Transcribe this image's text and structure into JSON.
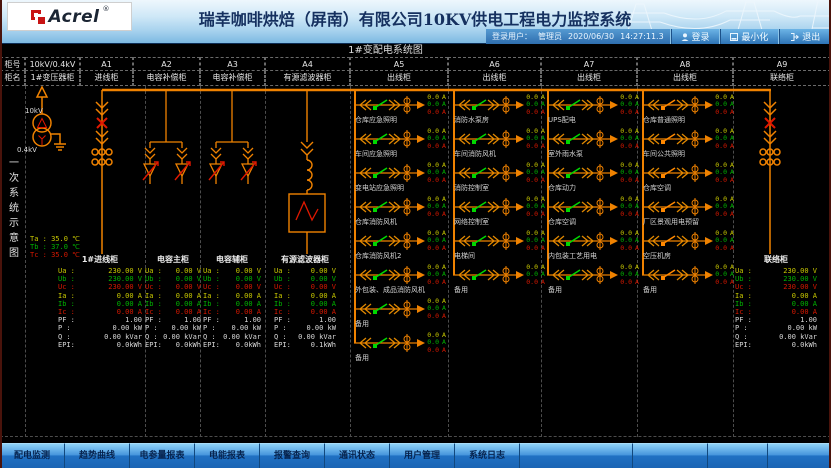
{
  "header": {
    "brand": "Acrel",
    "brand_reg": "®",
    "title": "瑞幸咖啡烘焙（屏南）有限公司10KV供电工程电力监控系统",
    "user_label": "登录用户：",
    "user_name": "管理员",
    "date": "2020/06/30",
    "time": "14:27:11.3",
    "login_label": "登录",
    "minimize_label": "最小化",
    "exit_label": "退出"
  },
  "diagram": {
    "title": "1#变配电系统图",
    "side_label": "一次系统示意图",
    "row_header_no": "柜号",
    "row_header_name": "柜名",
    "cabinets": [
      {
        "id": "T",
        "no": "10kV/0.4kV",
        "name": "1#变压器柜"
      },
      {
        "id": "A1",
        "no": "A1",
        "name": "进线柜"
      },
      {
        "id": "A2",
        "no": "A2",
        "name": "电容补偿柜"
      },
      {
        "id": "A3",
        "no": "A3",
        "name": "电容补偿柜"
      },
      {
        "id": "A4",
        "no": "A4",
        "name": "有源滤波器柜"
      },
      {
        "id": "A5",
        "no": "A5",
        "name": "出线柜"
      },
      {
        "id": "A6",
        "no": "A6",
        "name": "出线柜"
      },
      {
        "id": "A7",
        "no": "A7",
        "name": "出线柜"
      },
      {
        "id": "A8",
        "no": "A8",
        "name": "出线柜"
      },
      {
        "id": "A9",
        "no": "A9",
        "name": "联络柜"
      }
    ],
    "transformer": {
      "hv_label": "10kV",
      "lv_label": "0.4kV",
      "temperatures": [
        {
          "label": "Ta :",
          "value": "35.0 ℃",
          "color": "#c8c800"
        },
        {
          "label": "Tb :",
          "value": "37.0 ℃",
          "color": "#00b400"
        },
        {
          "label": "Tc :",
          "value": "35.0 ℃",
          "color": "#d81800"
        }
      ]
    },
    "value_colors": [
      "#c8c800",
      "#00b400",
      "#d81800",
      "#d8d8d8"
    ],
    "panels": [
      {
        "id": "P1",
        "title": "1#进线柜",
        "rows": [
          [
            "Ua :",
            "230.00 V",
            0
          ],
          [
            "Ub :",
            "230.00 V",
            1
          ],
          [
            "Uc :",
            "230.00 V",
            2
          ],
          [
            "Ia :",
            "0.00 A",
            0
          ],
          [
            "Ib :",
            "0.00 A",
            1
          ],
          [
            "Ic :",
            "0.00 A",
            2
          ],
          [
            "PF :",
            "1.00",
            3
          ],
          [
            "P :",
            "0.00 kW",
            3
          ],
          [
            "Q :",
            "0.00 kVar",
            3
          ],
          [
            "EPI:",
            "0.0kWh",
            3
          ]
        ]
      },
      {
        "id": "P2",
        "title": "电容主柜",
        "rows": [
          [
            "Ua :",
            "0.00 V",
            0
          ],
          [
            "Ub :",
            "0.00 V",
            1
          ],
          [
            "Uc :",
            "0.00 V",
            2
          ],
          [
            "Ia :",
            "0.00 A",
            0
          ],
          [
            "Ib :",
            "0.00 A",
            1
          ],
          [
            "Ic :",
            "0.00 A",
            2
          ],
          [
            "PF :",
            "1.00",
            3
          ],
          [
            "P :",
            "0.00 kW",
            3
          ],
          [
            "Q :",
            "0.00 kVar",
            3
          ],
          [
            "EPI:",
            "0.0kWh",
            3
          ]
        ]
      },
      {
        "id": "P3",
        "title": "电容辅柜",
        "rows": [
          [
            "Ua :",
            "0.00 V",
            0
          ],
          [
            "Ub :",
            "0.00 V",
            1
          ],
          [
            "Uc :",
            "0.00 V",
            2
          ],
          [
            "Ia :",
            "0.00 A",
            0
          ],
          [
            "Ib :",
            "0.00 A",
            1
          ],
          [
            "Ic :",
            "0.00 A",
            2
          ],
          [
            "PF :",
            "1.00",
            3
          ],
          [
            "P :",
            "0.00 kW",
            3
          ],
          [
            "Q :",
            "0.00 kVar",
            3
          ],
          [
            "EPI:",
            "0.0kWh",
            3
          ]
        ]
      },
      {
        "id": "P4",
        "title": "有源滤波器柜",
        "rows": [
          [
            "Ua :",
            "0.00 V",
            0
          ],
          [
            "Ub :",
            "0.00 V",
            1
          ],
          [
            "Uc :",
            "0.00 V",
            2
          ],
          [
            "Ia :",
            "0.00 A",
            0
          ],
          [
            "Ib :",
            "0.00 A",
            1
          ],
          [
            "Ic :",
            "0.00 A",
            2
          ],
          [
            "PF :",
            "1.00",
            3
          ],
          [
            "P :",
            "0.00 kW",
            3
          ],
          [
            "Q :",
            "0.00 kVar",
            3
          ],
          [
            "EPI:",
            "0.1kWh",
            3
          ]
        ]
      },
      {
        "id": "P9",
        "title": "联络柜",
        "rows": [
          [
            "Ua :",
            "230.00 V",
            0
          ],
          [
            "Ub :",
            "230.00 V",
            1
          ],
          [
            "Uc :",
            "230.00 V",
            2
          ],
          [
            "Ia :",
            "0.00 A",
            0
          ],
          [
            "Ib :",
            "0.00 A",
            1
          ],
          [
            "Ic :",
            "0.00 A",
            2
          ],
          [
            "PF :",
            "1.00",
            3
          ],
          [
            "P :",
            "0.00 kW",
            3
          ],
          [
            "Q :",
            "0.00 kVar",
            3
          ],
          [
            "EPI:",
            "0.0kWh",
            3
          ]
        ]
      }
    ],
    "feeder_phase_values": [
      "0.0",
      "0.0",
      "0.0"
    ],
    "feeder_phase_unit": "A",
    "feeder_columns": [
      {
        "id": "A5",
        "breaker_color": "#00d800",
        "feeders": [
          "仓库应急照明",
          "车间应急照明",
          "变电站应急照明",
          "仓库消防风机",
          "仓库消防风机2",
          "外包装、成品消防风机",
          "备用",
          "备用"
        ]
      },
      {
        "id": "A6",
        "breaker_color": "#00d800",
        "feeders": [
          "消防水泵房",
          "车间消防风机",
          "消防控制室",
          "网络控制室",
          "电梯间",
          "备用"
        ]
      },
      {
        "id": "A7",
        "breaker_color": "#00d800",
        "feeders": [
          "UPS配电",
          "室外雨水泵",
          "仓库动力",
          "仓库空调",
          "内包装工艺用电",
          "备用"
        ]
      },
      {
        "id": "A8",
        "breaker_color": "#ff8800",
        "feeders": [
          "仓库普通照明",
          "车间公共照明",
          "仓库空调",
          "厂区景观用电预留",
          "空压机房",
          "备用"
        ]
      }
    ]
  },
  "nav": {
    "tabs": [
      "配电监测",
      "趋势曲线",
      "电参量报表",
      "电能报表",
      "报警查询",
      "通讯状态",
      "用户管理",
      "系统日志",
      "",
      "",
      "",
      ""
    ]
  },
  "colors": {
    "bus_orange": "#f08200",
    "alarm_red": "#e01800",
    "panel_bg": "#000000",
    "header_blue": "#7db9e2"
  }
}
